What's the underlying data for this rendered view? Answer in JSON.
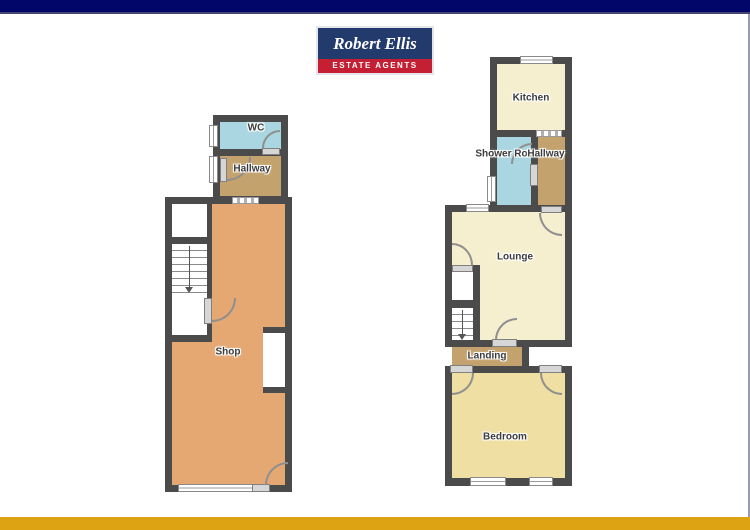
{
  "logo": {
    "title": "Robert Ellis",
    "subtitle": "ESTATE AGENTS",
    "navy": "#233a6d",
    "red": "#c41f33"
  },
  "page": {
    "top_bar_color": "#010668",
    "bottom_bar_color": "#dda312",
    "background": "#ffffff"
  },
  "colors": {
    "wall": "#4b4b4b",
    "wet_room_blue": "#a9d6e1",
    "hallway_tan": "#c3a26e",
    "shop_orange": "#e6a873",
    "living_cream": "#f6efcf",
    "bedroom_yellow": "#f0dfa2"
  },
  "ground_floor": {
    "rooms": {
      "wc": "WC",
      "hallway": "Hallway",
      "shop": "Shop"
    }
  },
  "first_floor": {
    "rooms": {
      "kitchen": "Kitchen",
      "shower_room": "Shower Room",
      "hallway": "Hallway",
      "lounge": "Lounge",
      "landing": "Landing",
      "bedroom": "Bedroom"
    }
  }
}
